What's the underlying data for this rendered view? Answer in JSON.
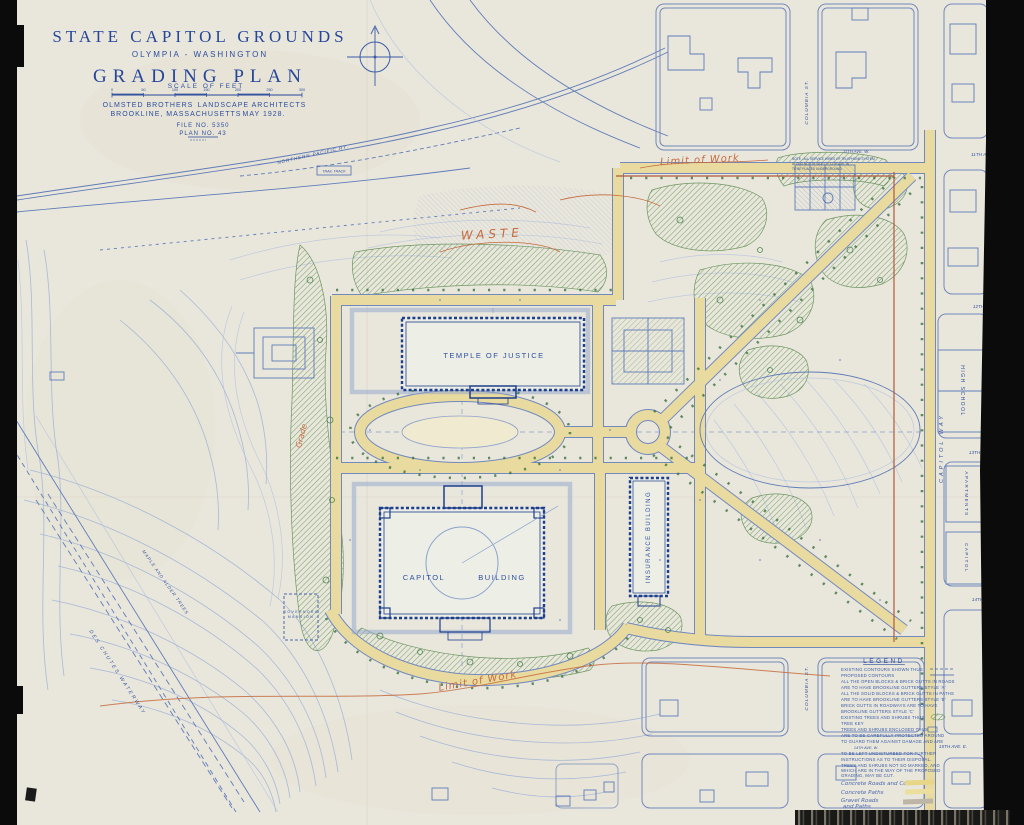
{
  "colors": {
    "paper": "#e9e6dc",
    "ink_dark": "#1d3e8c",
    "ink": "#3a5ca8",
    "ink_light": "#9db2d6",
    "annotation_orange": "#c66b3d",
    "vegetation_green": "#57894c",
    "road_yellow": "#e9db9f",
    "boundary_red": "#b2593a",
    "scan_black": "#0b0b0b"
  },
  "title_block": {
    "title": "STATE CAPITOL GROUNDS",
    "subtitle": "OLYMPIA - WASHINGTON",
    "plan_type": "GRADING PLAN",
    "scale_label": "SCALE OF FEET",
    "ticks": [
      "0",
      "50",
      "100",
      "150",
      "200",
      "250",
      "300"
    ],
    "firm": "OLMSTED BROTHERS",
    "firm_role": "LANDSCAPE ARCHITECTS",
    "firm_city": "BROOKLINE, MASSACHUSETTS",
    "date": "MAY 1928.",
    "file_no": "FILE NO. 5350",
    "plan_no": "PLAN NO. 43"
  },
  "buildings": {
    "temple": "TEMPLE OF JUSTICE",
    "capitol_a": "CAPITOL",
    "capitol_b": "BUILDING",
    "insurance": "INSURANCE BUILDING",
    "gov_a": "GOVERNORS",
    "gov_b": "MANSION",
    "high_school": "HIGH SCHOOL",
    "apartments": "APARTMENTS",
    "capitol_block": "CAPITOL"
  },
  "streets": {
    "columbia_top": "COLUMBIA ST.",
    "columbia_bottom": "COLUMBIA ST.",
    "capitol_way": "CAPITOL WAY",
    "ave_11w": "11TH AVE. W.",
    "ave_11e": "11TH AVE. E.",
    "ave_12e": "12TH AVE. E.",
    "ave_13e": "13TH AVE. E.",
    "ave_14e": "14TH AVE. E.",
    "ave_14w": "14TH AVE. W.",
    "ave_15e": "15TH AVE. E.",
    "railroad": "NORTHERN PACIFIC RY.",
    "trail": "TRAIL TRACK",
    "waterway": "DES CHUTES WATERWAY"
  },
  "annotations": {
    "waste": "WASTE",
    "limit_top": "Limit of Work",
    "limit_bottom": "Limit of Work",
    "grade": "Grade",
    "maple_alder": "MAPLE AND ALDER TREES",
    "note1": "NOTE - ALL SERVICE WIRES OF TELEPHONE SYSTEM",
    "note2": "ALONG NORTH SIDE OF 11TH AVE. W.",
    "note3": "TO BE PLACED UNDERGROUND."
  },
  "legend": {
    "title": "LEGEND",
    "lines": [
      "EXISTING CONTOURS SHOWN THUS",
      "PROPOSED CONTOURS",
      "ALL THE OPEN BLOCKS & BRICK GUTTS IN ROADS",
      "ARE TO HAVE BROOKLINE GUTTERS STYLE 'A'",
      "ALL THE SOLID BLOCKS & BRICK GUTTS IN PATHS",
      "ARE TO HAVE BROOKLINE GUTTERS STYLE 'B'",
      "BRICK GUTTS IN ROADWAYS ARE TO HAVE",
      "BROOKLINE GUTTERS STYLE 'C'",
      "EXISTING TREES AND SHRUBS THUS",
      "TREE KEY",
      "TREES AND SHRUBS ENCLOSED THUS",
      "ARE TO BE CAREFULLY PROTECTED AROUND",
      "TO GUARD THEM AGAINST DAMAGE AND ARE",
      "TO BE LEFT UNDISTURBED FOR FURTHER",
      "INSTRUCTIONS AS TO THEIR DISPOSAL.",
      "TREES AND SHRUBS NOT SO MARKED, AND",
      "WHICH ARE IN THE WAY OF THE PROPOSED",
      "GRADING, MAY BE CUT."
    ],
    "key": {
      "k1": "Concrete Roads and Curbs",
      "k2": "Concrete Paths",
      "k3a": "Gravel Roads",
      "k3b": "and Paths"
    }
  }
}
